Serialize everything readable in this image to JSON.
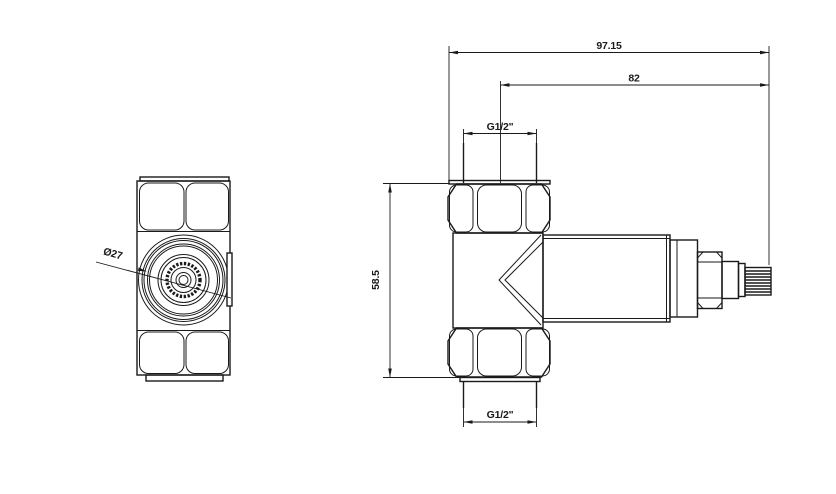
{
  "drawing_type": "technical-dimension-drawing",
  "colors": {
    "line": "#1a1a1a",
    "background": "#ffffff"
  },
  "dimensions": {
    "overall_length": "97.15",
    "stem_to_axis": "82",
    "top_thread": "G1/2\"",
    "bottom_thread": "G1/2\"",
    "body_height": "58.5",
    "knob_diameter": "Ø27"
  }
}
